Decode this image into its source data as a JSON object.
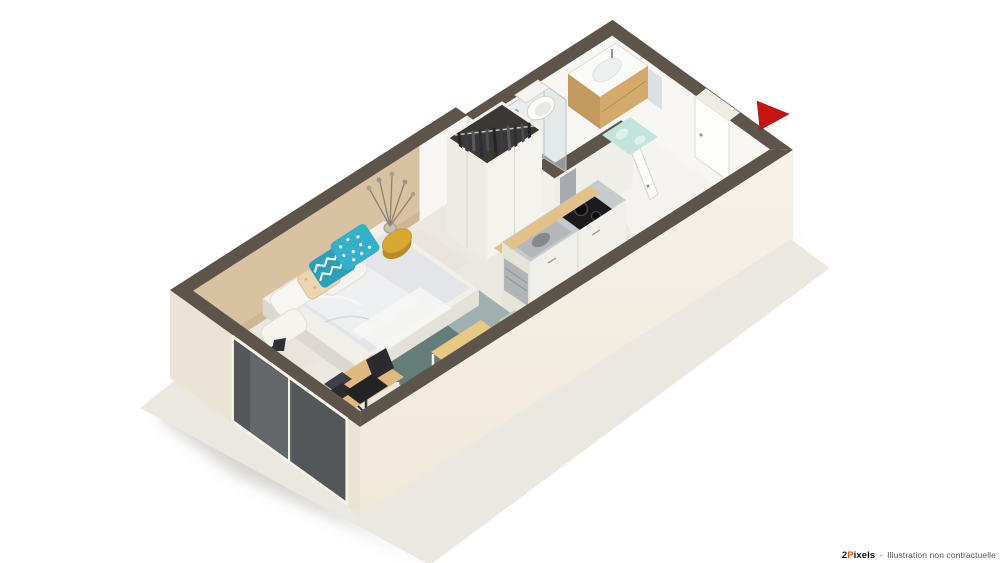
{
  "illustration": {
    "title": "3D isometric floor plan of a furnished studio apartment",
    "entrance_arrow": "entrance-direction-arrow"
  },
  "colors": {
    "wall_top": "#5d554b",
    "wall_exterior": "#f3efe5",
    "wall_exterior_shaded": "#eae3d6",
    "wall_interior": "#f7f6f3",
    "accent_wall": "#d9c2a2",
    "floor": "#ebe8e1",
    "floor_hall": "#f6f5f1",
    "bathroom_floor": "#f8f8f6",
    "window_glass": "#53575a",
    "rug_light": "#9fb0af",
    "rug_dark": "#5d7873",
    "bed_linen": "#f1efe9",
    "duvet": "#e4e5e8",
    "pillow_teal_chevron": "#2c9fb9",
    "pillow_teal_dot": "#35b0c9",
    "pillow_beige": "#ecd5b0",
    "wood_counter": "#e2c288",
    "wood_desk": "#dfb97f",
    "wood_vanity": "#d3a96c",
    "wood_table": "#e8c885",
    "cabinet_white": "#f1efe9",
    "chair_sage": "#c9d4be",
    "chair_olive": "#5f6b4f",
    "stool_seat": "#4a5044",
    "black_furniture": "#232326",
    "steel": "#b4b8ba",
    "cooktop": "#1b1b1e",
    "mat_mint": "#c2e4dd",
    "side_table_gold": "#d9a833",
    "arrow_red": "#c51414"
  },
  "watermark": {
    "brand_num": "2",
    "brand_p": "P",
    "brand_rest": "ixels",
    "separator": "-",
    "note": "Illustration non contractuelle"
  }
}
